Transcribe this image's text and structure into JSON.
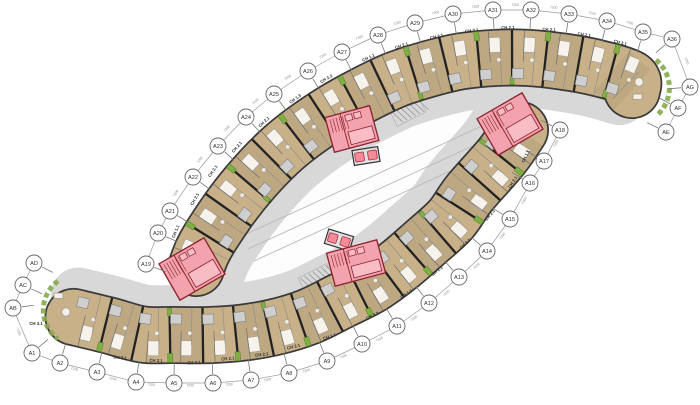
{
  "drawing": {
    "type": "apartment-floor-plan",
    "dimension_label": "7200",
    "colors": {
      "background": "#ffffff",
      "wood": "#c8b189",
      "wood_outline": "#3a3a3a",
      "corridor": "#d8d8d8",
      "courtyard": "#fdfdfd",
      "courtyard_stroke": "#b5b5b5",
      "core_fill": "#f2a3ad",
      "core_stroke": "#8c2230",
      "core_inner": "#f7bcc4",
      "elevator_fill": "#f08b97",
      "elevator_stroke": "#b23046",
      "planter": "#7fae45",
      "planter_stroke": "#55802a",
      "bed_fill": "#f6f3ec",
      "bed_stroke": "#a89f8f",
      "bath_fill": "#cfcfcf",
      "bath_stroke": "#808080",
      "wall": "#222222",
      "chain": "#9a9a9a",
      "tick": "#777777",
      "dim_text": "#8a8a8a",
      "bubble_fill": "#ffffff",
      "bubble_stroke": "#666666",
      "bubble_text": "#333333",
      "unit_label": "#2f2f2f",
      "lane": "#b8b8b8",
      "hatch": "#999999"
    },
    "axis_bubbles": {
      "top_chain": [
        {
          "label": "A19",
          "x": 146,
          "y": 264
        },
        {
          "label": "A20",
          "x": 158,
          "y": 233
        },
        {
          "label": "A21",
          "x": 170,
          "y": 211
        },
        {
          "label": "A22",
          "x": 193,
          "y": 177
        },
        {
          "label": "A23",
          "x": 218,
          "y": 146
        },
        {
          "label": "A24",
          "x": 246,
          "y": 117
        },
        {
          "label": "A25",
          "x": 274,
          "y": 94
        },
        {
          "label": "A26",
          "x": 308,
          "y": 71
        },
        {
          "label": "A27",
          "x": 342,
          "y": 52
        },
        {
          "label": "A28",
          "x": 378,
          "y": 35
        },
        {
          "label": "A29",
          "x": 415,
          "y": 23
        },
        {
          "label": "A30",
          "x": 453,
          "y": 14
        },
        {
          "label": "A31",
          "x": 493,
          "y": 10
        },
        {
          "label": "A32",
          "x": 531,
          "y": 10
        },
        {
          "label": "A33",
          "x": 569,
          "y": 14
        },
        {
          "label": "A34",
          "x": 607,
          "y": 21
        },
        {
          "label": "A35",
          "x": 643,
          "y": 32
        },
        {
          "label": "A36",
          "x": 672,
          "y": 39
        },
        {
          "label": "AG",
          "x": 690,
          "y": 87
        },
        {
          "label": "AF",
          "x": 678,
          "y": 108
        },
        {
          "label": "AE",
          "x": 666,
          "y": 132
        }
      ],
      "bottom_chain": [
        {
          "label": "AD",
          "x": 34,
          "y": 263
        },
        {
          "label": "AC",
          "x": 23,
          "y": 285
        },
        {
          "label": "AB",
          "x": 13,
          "y": 308
        },
        {
          "label": "A1",
          "x": 32,
          "y": 353
        },
        {
          "label": "A2",
          "x": 60,
          "y": 363
        },
        {
          "label": "A3",
          "x": 97,
          "y": 372
        },
        {
          "label": "A4",
          "x": 136,
          "y": 382
        },
        {
          "label": "A5",
          "x": 174,
          "y": 383
        },
        {
          "label": "A6",
          "x": 213,
          "y": 383
        },
        {
          "label": "A7",
          "x": 251,
          "y": 380
        },
        {
          "label": "A8",
          "x": 289,
          "y": 373
        },
        {
          "label": "A9",
          "x": 327,
          "y": 361
        },
        {
          "label": "A10",
          "x": 362,
          "y": 344
        },
        {
          "label": "A11",
          "x": 397,
          "y": 326
        },
        {
          "label": "A12",
          "x": 429,
          "y": 303
        },
        {
          "label": "A13",
          "x": 459,
          "y": 277
        },
        {
          "label": "A14",
          "x": 487,
          "y": 251
        },
        {
          "label": "A15",
          "x": 510,
          "y": 219
        },
        {
          "label": "A16",
          "x": 530,
          "y": 183
        },
        {
          "label": "A17",
          "x": 544,
          "y": 161
        },
        {
          "label": "A18",
          "x": 560,
          "y": 130
        }
      ]
    },
    "wings": {
      "inward_gap": 48,
      "units_per_wing": 16,
      "upper": {
        "chain": "top_chain",
        "range": [
          0,
          16
        ],
        "start_override": [
          196,
          268
        ],
        "extra_end": [
          [
            632,
            90
          ]
        ],
        "outer_sign": 1
      },
      "lower": {
        "chain": "bottom_chain",
        "range": [
          4,
          17
        ],
        "extra_end": [
          [
            502,
            156
          ],
          [
            520,
            130
          ]
        ],
        "outer_sign": -1
      }
    },
    "unit_labels": [
      {
        "text": "CH 1.1",
        "x": 177,
        "y": 232,
        "r": -68
      },
      {
        "text": "CH 2.1",
        "x": 196,
        "y": 200,
        "r": -60
      },
      {
        "text": "CH 2.1",
        "x": 214,
        "y": 172,
        "r": -55
      },
      {
        "text": "CH 2.1",
        "x": 238,
        "y": 148,
        "r": -50
      },
      {
        "text": "CH 2.1",
        "x": 265,
        "y": 123,
        "r": -43
      },
      {
        "text": "CH 1.3",
        "x": 296,
        "y": 100,
        "r": -36
      },
      {
        "text": "CH 2.2",
        "x": 327,
        "y": 80,
        "r": -30
      },
      {
        "text": "CH 1.1",
        "x": 369,
        "y": 59,
        "r": -24
      },
      {
        "text": "CH 2.1",
        "x": 402,
        "y": 47,
        "r": -18
      },
      {
        "text": "CH 2.1",
        "x": 437,
        "y": 38,
        "r": -13
      },
      {
        "text": "CH 2.1",
        "x": 472,
        "y": 32,
        "r": -8
      },
      {
        "text": "CH 2.1",
        "x": 508,
        "y": 29,
        "r": -3
      },
      {
        "text": "CH 2.1",
        "x": 549,
        "y": 31,
        "r": 3
      },
      {
        "text": "CH 2.1",
        "x": 584,
        "y": 36,
        "r": 8
      },
      {
        "text": "CH 3.1",
        "x": 620,
        "y": 44,
        "r": 14
      },
      {
        "text": "CH 3.1",
        "x": 36,
        "y": 325,
        "r": 0
      },
      {
        "text": "CH 2.1",
        "x": 120,
        "y": 359,
        "r": 5
      },
      {
        "text": "CH 2.1",
        "x": 156,
        "y": 362,
        "r": 2
      },
      {
        "text": "CH 2.1",
        "x": 194,
        "y": 364,
        "r": -3
      },
      {
        "text": "CH 2.1",
        "x": 228,
        "y": 360,
        "r": -5
      },
      {
        "text": "CH 2.1",
        "x": 262,
        "y": 356,
        "r": -8
      },
      {
        "text": "CH 2.1",
        "x": 294,
        "y": 348,
        "r": -14
      },
      {
        "text": "CH 1.1",
        "x": 330,
        "y": 338,
        "r": -18
      },
      {
        "text": "CH 2.2",
        "x": 373,
        "y": 317,
        "r": -25
      },
      {
        "text": "CH 1.3",
        "x": 407,
        "y": 295,
        "r": -32
      },
      {
        "text": "CH 2.1",
        "x": 438,
        "y": 272,
        "r": -38
      },
      {
        "text": "CH 2.1",
        "x": 466,
        "y": 245,
        "r": -44
      },
      {
        "text": "CH 2.1",
        "x": 491,
        "y": 216,
        "r": -50
      },
      {
        "text": "CH 2.1",
        "x": 514,
        "y": 183,
        "r": -58
      },
      {
        "text": "CH 1.1",
        "x": 527,
        "y": 157,
        "r": -64
      }
    ],
    "cores": [
      {
        "x": 352,
        "y": 129,
        "w": 46,
        "h": 36,
        "r": -15
      },
      {
        "x": 510,
        "y": 124,
        "w": 52,
        "h": 42,
        "r": -30
      },
      {
        "x": 192,
        "y": 269,
        "w": 52,
        "h": 42,
        "r": -30
      },
      {
        "x": 356,
        "y": 263,
        "w": 52,
        "h": 34,
        "r": -15
      }
    ],
    "elevator_banks": [
      {
        "x": 366,
        "y": 156,
        "r": -9
      },
      {
        "x": 339,
        "y": 240,
        "r": 17
      }
    ],
    "ramps": [
      {
        "x": 408,
        "y": 112,
        "r": -27
      },
      {
        "x": 316,
        "y": 278,
        "r": -27
      }
    ]
  }
}
